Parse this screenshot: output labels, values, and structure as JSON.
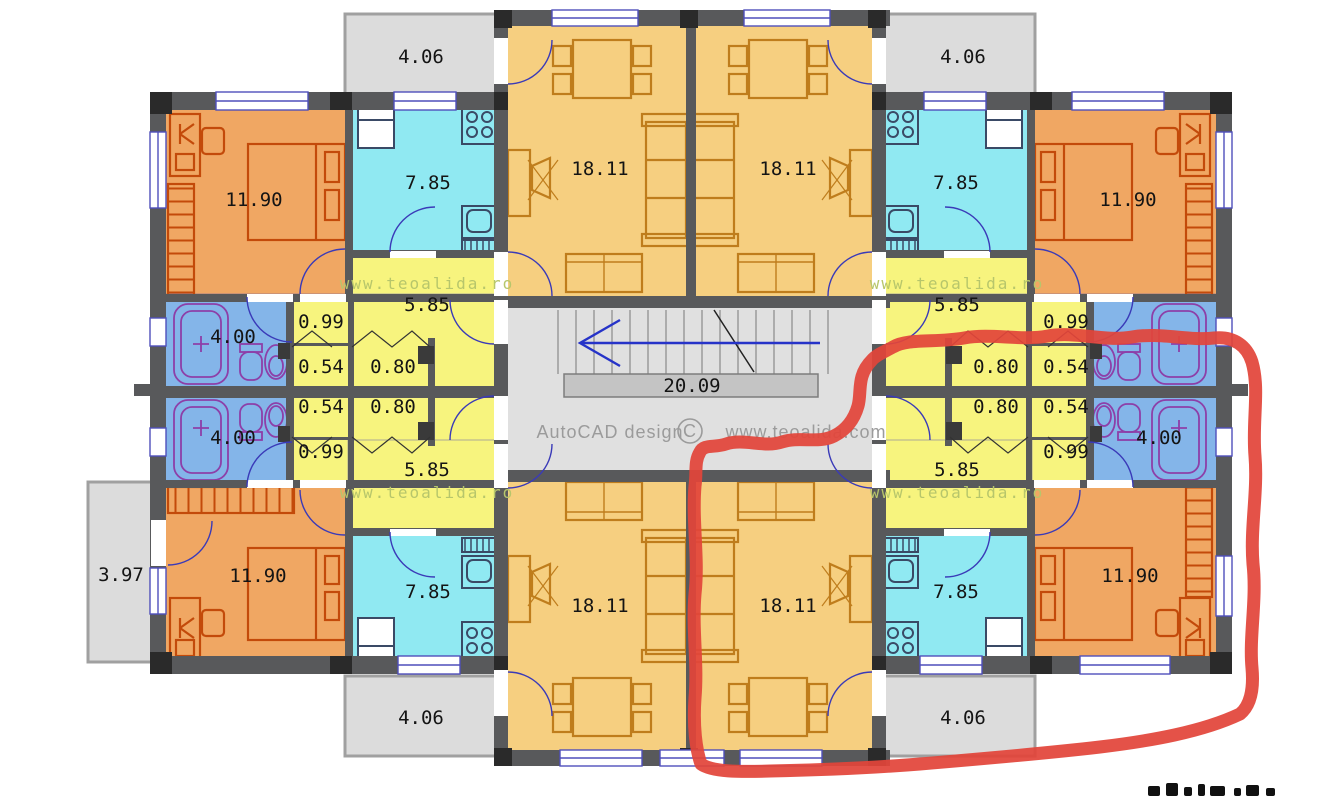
{
  "plan": {
    "watermark": "www.teoalida.ro",
    "credit": "AutoCAD design",
    "copyright_symbol": "C",
    "credit_site": "www.teoalida.com",
    "areas": {
      "bedroom": "11.90",
      "kitchen": "7.85",
      "living_room": "18.11",
      "hallway": "5.85",
      "bathroom": "4.00",
      "closet_small": "0.99",
      "closet_tiny": "0.54",
      "closet_wide": "0.80",
      "balcony": "4.06",
      "side_balcony": "3.97",
      "staircase_landing": "20.09"
    },
    "stairwell": {
      "arrow_direction": "left"
    },
    "annotation": {
      "type": "hand-drawn red marker loop around bottom-right apartment",
      "color": "#e2453a"
    },
    "colors": {
      "bedroom": "#f0a763",
      "kitchen": "#90e9f2",
      "living_room": "#f6cf80",
      "hallway": "#f7f47e",
      "bathroom": "#84b5e9",
      "balcony": "#dcdcdc",
      "wall": "#58595b",
      "annotation": "#e2453a"
    }
  }
}
